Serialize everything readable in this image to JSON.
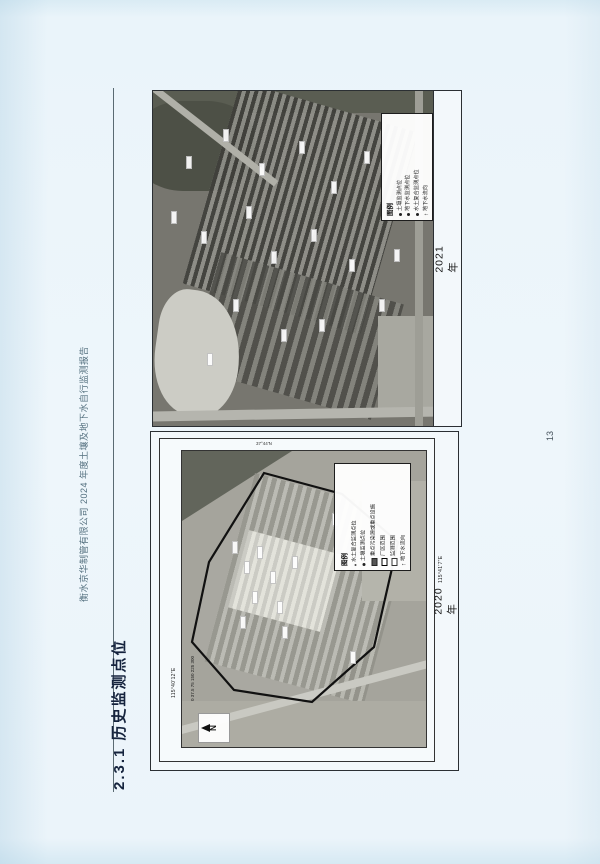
{
  "page": {
    "header_title": "衡水京华制管有限公司 2024 年度土壤及地下水自行监测报告",
    "section_heading": "2.3.1  历史监测点位",
    "page_number": "13"
  },
  "figure_2021": {
    "year_label": "2021 年",
    "legend": {
      "title": "图例",
      "items": [
        {
          "symbol": "dot",
          "label": "土壤监测点位"
        },
        {
          "symbol": "dot",
          "label": "地下水监测点位"
        },
        {
          "symbol": "dot",
          "label": "水土复合监测点位"
        },
        {
          "symbol": "arrow",
          "label": "地下水流向"
        }
      ]
    },
    "markers": [
      [
        18,
        120
      ],
      [
        33,
        65
      ],
      [
        48,
        140
      ],
      [
        70,
        38
      ],
      [
        93,
        115
      ],
      [
        106,
        72
      ],
      [
        118,
        160
      ],
      [
        146,
        50
      ],
      [
        158,
        138
      ],
      [
        178,
        90
      ],
      [
        196,
        168
      ],
      [
        211,
        60
      ],
      [
        226,
        208
      ],
      [
        128,
        238
      ],
      [
        80,
        208
      ],
      [
        54,
        262
      ],
      [
        166,
        228
      ],
      [
        241,
        158
      ]
    ]
  },
  "figure_2020": {
    "year_label": "2020 年",
    "legend": {
      "title": "图例",
      "items": [
        {
          "symbol": "dot-sm",
          "label": "水土复合监测点位"
        },
        {
          "symbol": "dot",
          "label": "土壤监测点位"
        },
        {
          "symbol": "rect-filled",
          "label": "重点污染源或重点设施"
        },
        {
          "symbol": "rect-bold",
          "label": "厂区范围"
        },
        {
          "symbol": "rect-thin",
          "label": "监测范围"
        },
        {
          "symbol": "arrow",
          "label": "地下水流向"
        }
      ]
    },
    "north_label": "N",
    "scale_text": "0 37.5 75 150 225 300",
    "coordinates": {
      "west_edge": "115°40'12\"E",
      "east_edge": "115°41'7\"E",
      "north_edge": "37°44'N"
    },
    "markers": [
      [
        50,
        90
      ],
      [
        62,
        110
      ],
      [
        75,
        95
      ],
      [
        88,
        120
      ],
      [
        70,
        140
      ],
      [
        95,
        150
      ],
      [
        110,
        105
      ],
      [
        58,
        165
      ],
      [
        100,
        175
      ],
      [
        150,
        62
      ],
      [
        168,
        200
      ]
    ]
  }
}
